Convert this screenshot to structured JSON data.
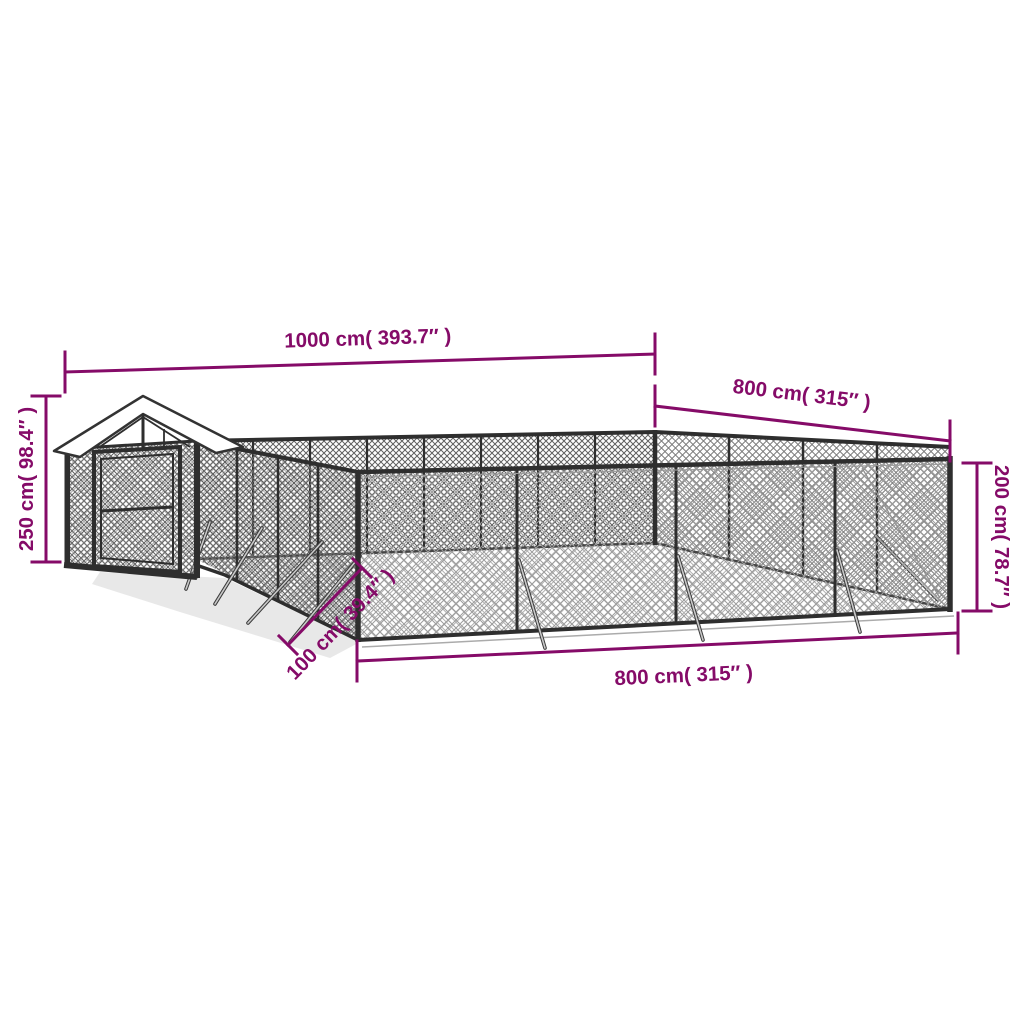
{
  "page": {
    "background_color": "#ffffff"
  },
  "diagram": {
    "type": "product-dimension-diagram",
    "accent_color": "#850B68",
    "frame_color": "#2E2E2E",
    "roof_color": "#FFFFFF",
    "mesh_colors": {
      "dark": "#606060",
      "mid": "#7D7D7D",
      "light": "#9C9C9C",
      "floor": "#B0B0B0"
    },
    "dimensions": {
      "back_width": {
        "label": "1000 cm( 393.7″ )"
      },
      "side_depth": {
        "label": "800 cm( 315″ )"
      },
      "house_height": {
        "label": "250 cm( 98.4″ )"
      },
      "fence_height": {
        "label": "200 cm( 78.7″ )"
      },
      "front_width": {
        "label": "800 cm( 315″ )"
      },
      "entry_depth": {
        "label": "100 cm( 39.4″ )"
      }
    }
  }
}
